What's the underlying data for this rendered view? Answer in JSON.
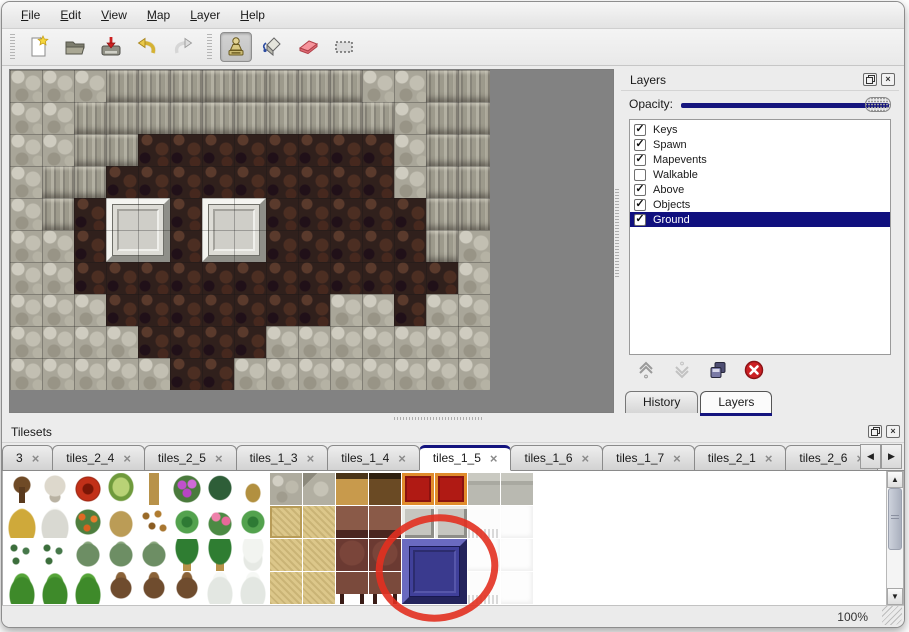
{
  "menu": {
    "items": [
      {
        "label": "File"
      },
      {
        "label": "Edit"
      },
      {
        "label": "View"
      },
      {
        "label": "Map"
      },
      {
        "label": "Layer"
      },
      {
        "label": "Help"
      }
    ]
  },
  "toolbar": {
    "buttons": [
      {
        "name": "new"
      },
      {
        "name": "open"
      },
      {
        "name": "save"
      },
      {
        "name": "undo"
      },
      {
        "name": "redo"
      }
    ],
    "tools": [
      {
        "name": "stamp",
        "selected": true
      },
      {
        "name": "fill",
        "selected": false
      },
      {
        "name": "eraser",
        "selected": false
      },
      {
        "name": "select",
        "selected": false
      }
    ]
  },
  "map": {
    "tile_size": 32,
    "grid": [
      "CCCWWWWWWWWCCWW",
      "CCWWWWWWWWWWCWW",
      "CCWWFFFFFFFFCWW",
      "CWWFFFFFFFFFCWW",
      "CWFFFFFFFFFFFWW",
      "CCFFFFFFFFFFFWC",
      "CCFFFFFFFFFFFFC",
      "CCCFFFFFFFCCFCC",
      "CCCCFFFFCCCCCCC",
      "CCCCCFFCCCCCCCC"
    ],
    "platforms": [
      {
        "col": 3,
        "row": 4
      },
      {
        "col": 6,
        "row": 4
      }
    ]
  },
  "layers_panel": {
    "title": "Layers",
    "opacity_label": "Opacity:",
    "layers": [
      {
        "name": "Keys",
        "checked": true,
        "selected": false
      },
      {
        "name": "Spawn",
        "checked": true,
        "selected": false
      },
      {
        "name": "Mapevents",
        "checked": true,
        "selected": false
      },
      {
        "name": "Walkable",
        "checked": false,
        "selected": false
      },
      {
        "name": "Above",
        "checked": true,
        "selected": false
      },
      {
        "name": "Objects",
        "checked": true,
        "selected": false
      },
      {
        "name": "Ground",
        "checked": true,
        "selected": true
      }
    ],
    "tabs": [
      {
        "label": "History",
        "active": false
      },
      {
        "label": "Layers",
        "active": true
      }
    ]
  },
  "tilesets_panel": {
    "title": "Tilesets",
    "tabs": [
      {
        "label": "3",
        "active": false
      },
      {
        "label": "tiles_2_4",
        "active": false
      },
      {
        "label": "tiles_2_5",
        "active": false
      },
      {
        "label": "tiles_1_3",
        "active": false
      },
      {
        "label": "tiles_1_4",
        "active": false
      },
      {
        "label": "tiles_1_5",
        "active": true
      },
      {
        "label": "tiles_1_6",
        "active": false
      },
      {
        "label": "tiles_1_7",
        "active": false
      },
      {
        "label": "tiles_2_1",
        "active": false
      },
      {
        "label": "tiles_2_6",
        "active": false
      }
    ],
    "grid": [
      [
        "trunk",
        "deadtree",
        "redflower",
        "stump",
        "palmtrunk",
        "purplebush",
        "fern",
        "sprout",
        "cobble",
        "cobble2",
        "woodtop",
        "wooddark",
        "carpet",
        "carpet",
        "stonecol",
        "stonecol"
      ],
      [
        "haypile",
        "snowpile",
        "orangeflower",
        "drygrass",
        "leaves",
        "lily",
        "pinkflower",
        "lily",
        "tanedge",
        "tanweave",
        "tabletop",
        "tabletop",
        "grayblock",
        "grayblock",
        "fringe",
        "white"
      ],
      [
        "sprigs",
        "sprigs",
        "bush",
        "bush",
        "bush",
        "palm",
        "palm",
        "snowpalm",
        "tanweave",
        "tanweave",
        "browntile",
        "browntile",
        "blue",
        "blue",
        "white",
        "white"
      ],
      [
        "conifer",
        "conifer",
        "conifer",
        "deadtwist",
        "deadtwist",
        "deadtwist",
        "snowpine",
        "snowpine",
        "tanweave",
        "tanweave",
        "tablelegs",
        "tablelegs",
        "blue",
        "blue",
        "fringe",
        "white"
      ]
    ],
    "blue_block": {
      "col": 12,
      "row": 2
    }
  },
  "annotation": {
    "shape": "ellipse",
    "color": "#e23020"
  },
  "statusbar": {
    "zoom": "100%"
  },
  "colors": {
    "accent_navy": "#14147e",
    "selection_navy": "#10107e",
    "delete_red": "#cc2024",
    "annotation_red": "#e23020",
    "canvas_gray": "#828282"
  }
}
